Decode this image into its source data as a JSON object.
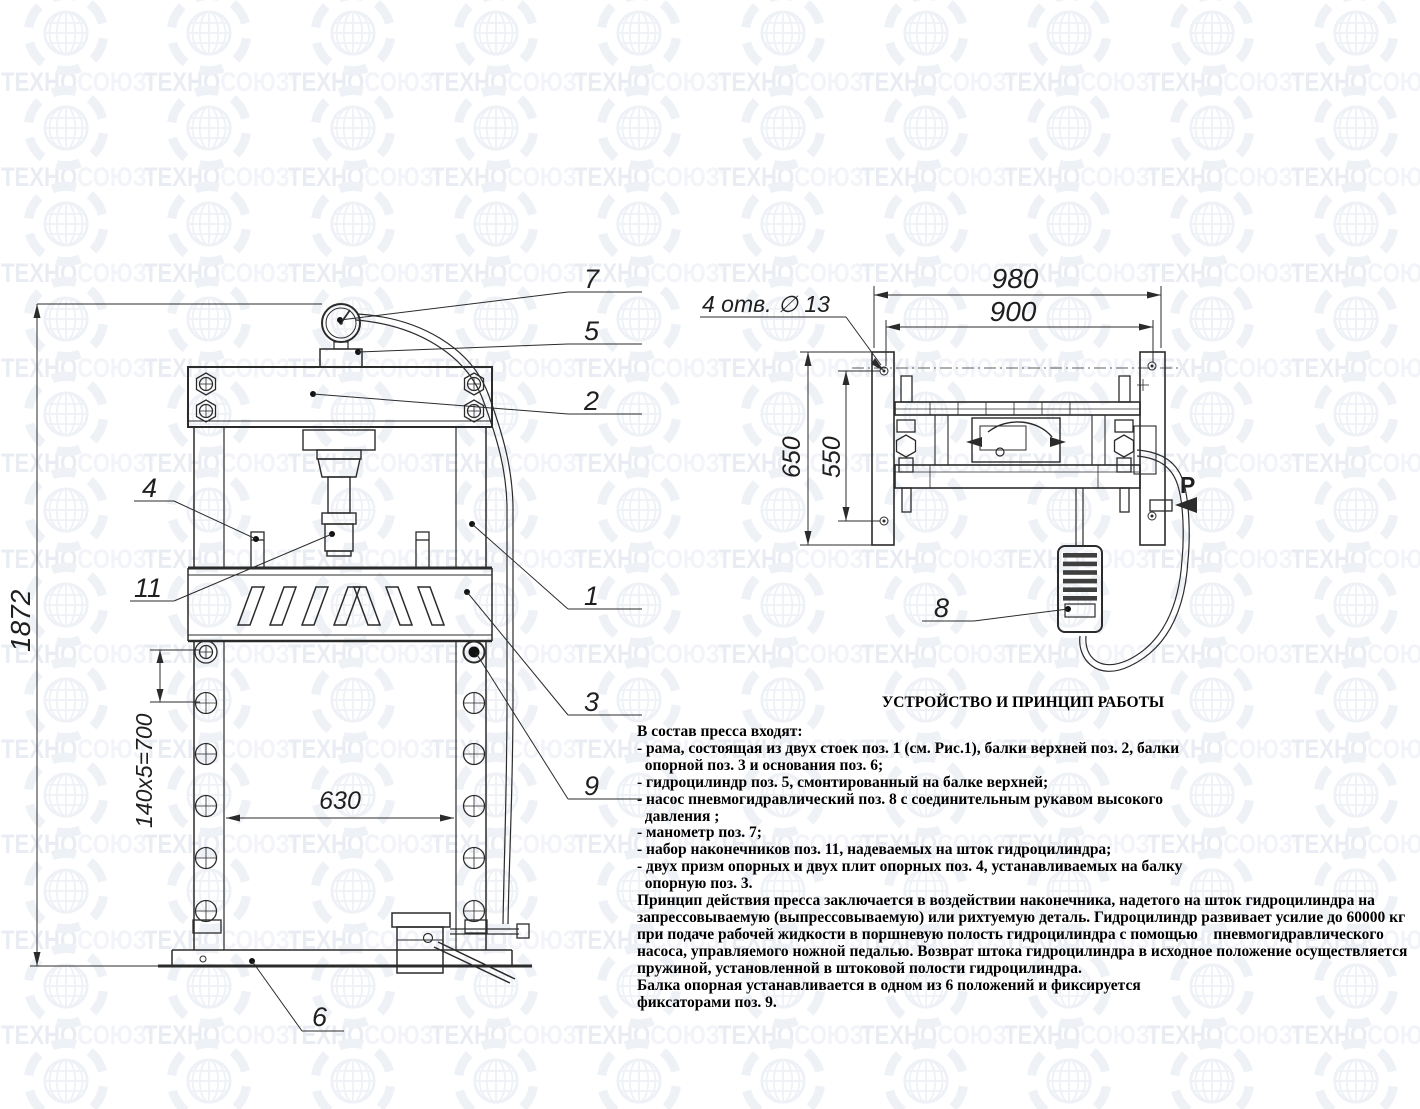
{
  "watermark": {
    "brand_head": "ТЕХНО",
    "brand_tail": "СОЮЗ",
    "reg": "®",
    "color_head": "#e9edf3",
    "color_tail": "#f2f4f9",
    "color_globe": "#eef1f6"
  },
  "colors": {
    "drawing_line": "#2b2b2b"
  },
  "front_view": {
    "dims": {
      "overall_height": "1872",
      "hole_pattern": "140x5=700",
      "table_width": "630"
    },
    "callouts": {
      "n1": "1",
      "n2": "2",
      "n3": "3",
      "n4": "4",
      "n5": "5",
      "n6": "6",
      "n7": "7",
      "n9": "9",
      "n11": "11"
    }
  },
  "top_view": {
    "dims": {
      "overall_width": "980",
      "hole_span_horizontal": "900",
      "plate_height": "650",
      "hole_span_vertical": "550"
    },
    "labels": {
      "holes_note": "4 отв. ∅ 13",
      "pressure": "P"
    },
    "callouts": {
      "n8": "8"
    }
  },
  "description": {
    "title": "УСТРОЙСТВО И ПРИНЦИП РАБОТЫ",
    "lines": [
      "В состав пресса входят:",
      "- рама, состоящая из двух стоек поз. 1 (см. Рис.1), балки верхней поз. 2, балки",
      "  опорной поз. 3 и основания поз. 6;",
      "- гидроцилиндр поз. 5, смонтированный на балке верхней;",
      "- насос пневмогидравлический поз. 8 с соединительным рукавом высокого",
      "  давления ;",
      "- манометр поз. 7;",
      "- набор наконечников поз. 11, надеваемых на шток гидроцилиндра;",
      "- двух призм опорных и двух плит опорных поз. 4, устанавливаемых на балку",
      "  опорную поз. 3.",
      "Принцип действия пресса заключается в воздействии наконечника, надетого на шток гидроцилиндра на",
      "запрессовываемую (выпрессовываемую) или рихтуемую деталь. Гидроцилиндр развивает усилие до 60000 кг",
      "при подаче рабочей жидкости в поршневую полость гидроцилиндра с помощью    пневмогидравлического",
      "насоса, управляемого ножной педалью. Возврат штока гидроцилиндра в исходное положение осуществляется",
      "пружиной, установленной в штоковой полости гидроцилиндра.",
      "Балка опорная устанавливается в одном из 6 положений и фиксируется",
      "фиксаторами поз. 9."
    ]
  }
}
